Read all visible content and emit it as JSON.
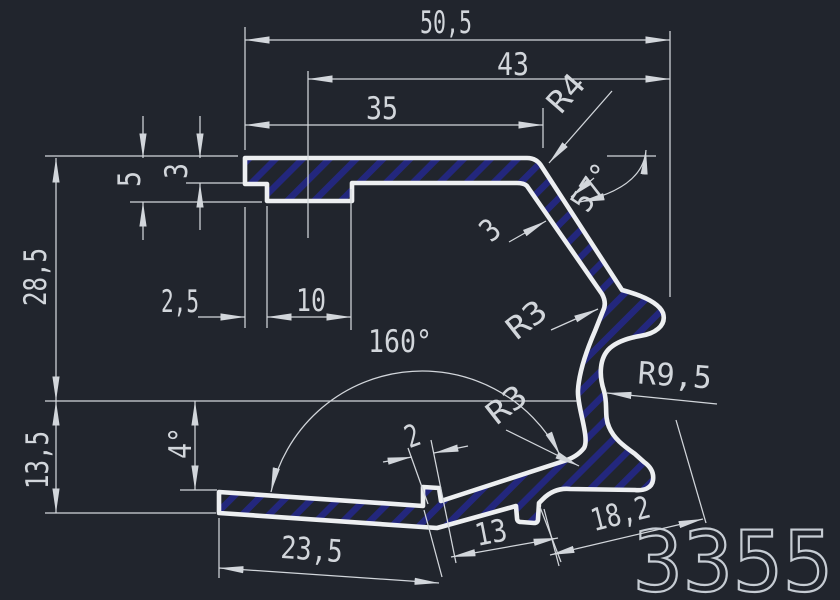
{
  "colors": {
    "bg": "#21252d",
    "stroke": "#edeff1",
    "dim": "#d2d6db",
    "hatch": "#23277d",
    "big": "#c6ccd3"
  },
  "labels": {
    "overall_width": "50,5",
    "channel_center_width": "43",
    "top_length": "35",
    "step_offset": "2,5",
    "channel_width": "10",
    "step_depth": "5",
    "top_thickness": "3",
    "upper_height": "28,5",
    "lower_height": "13,5",
    "flange_tilt_angle": "4°",
    "flange_bend_angle": "160°",
    "top_corner_radius": "R4",
    "wall_angle": "57°",
    "wall_thickness": "3",
    "hook_inner_radius": "R3",
    "root_radius": "R3",
    "wall_bend_radius": "R9,5",
    "tab_width": "2",
    "tab_spacing": "13",
    "flange_left_length": "23,5",
    "foot_length": "18,2",
    "part_number": "3355"
  }
}
